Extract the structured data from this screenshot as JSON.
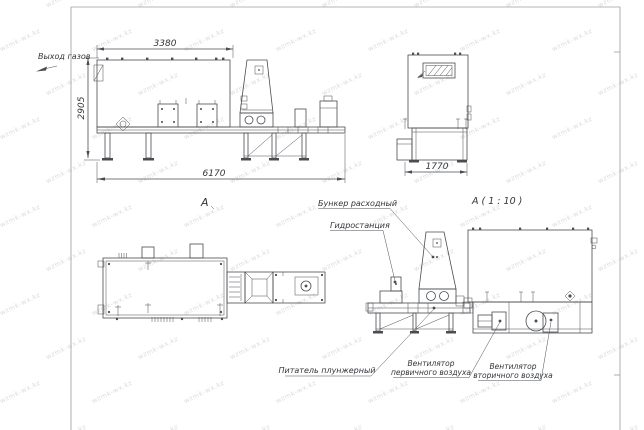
{
  "page": {
    "background": "#ffffff"
  },
  "colors": {
    "line": "#4a4c50",
    "text": "#33353a",
    "border": "#9b9b9b",
    "watermark": "#dcdcdc"
  },
  "watermark": {
    "text": "wzmk-wx.kz"
  },
  "labels": {
    "gas_outlet": "Выход газов",
    "view_a": "А",
    "detail_a": "А ( 1 : 10 )",
    "feed_hopper": "Бункер расходный",
    "hydraulic_station": "Гидростанция",
    "plunger_feeder": "Питатель плунжерный",
    "primary_fan": {
      "line1": "Вентилятор",
      "line2": "первичного воздуха"
    },
    "secondary_fan": {
      "line1": "Вентилятор",
      "line2": "вторичного воздуха"
    }
  },
  "dimensions": {
    "upper_frame_length": "3380",
    "overall_height": "2905",
    "overall_length": "6170",
    "overall_width": "1770"
  }
}
